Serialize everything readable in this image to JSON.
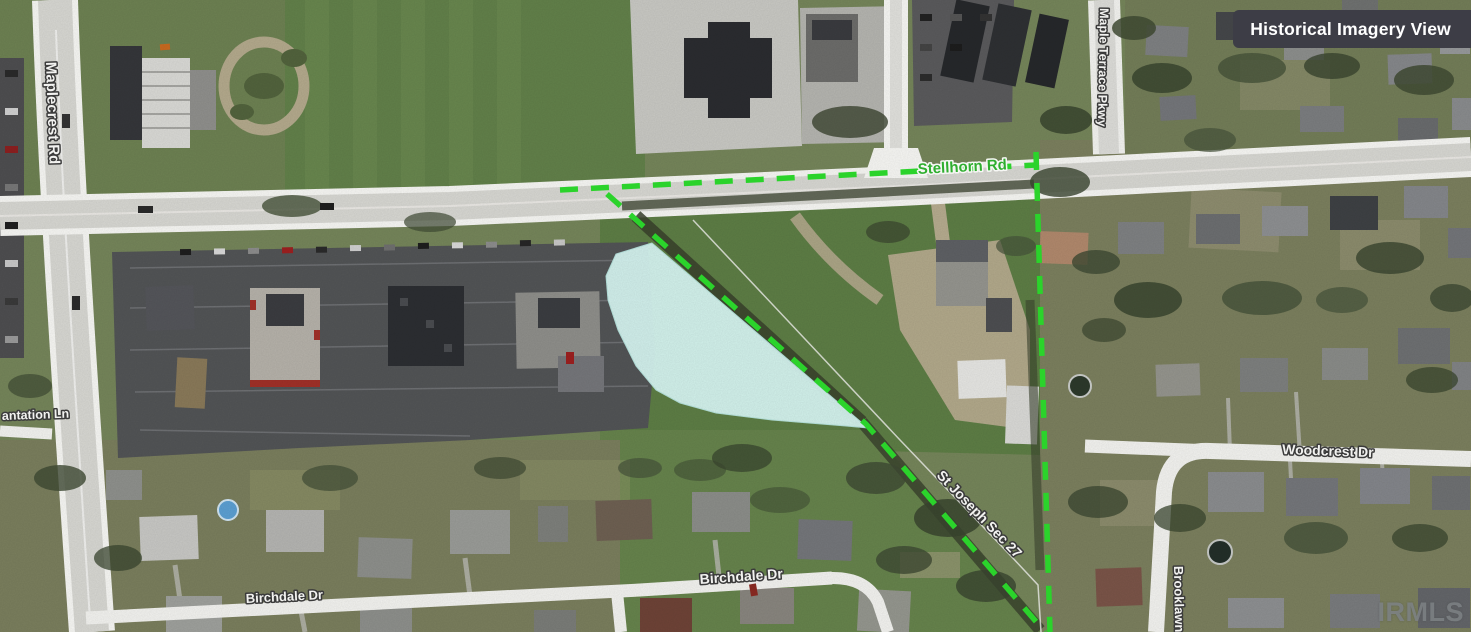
{
  "view": {
    "badge_label": "Historical Imagery View",
    "watermark": "IRMLS"
  },
  "map": {
    "labels": {
      "maplecrest": "Maplecrest Rd",
      "stellhorn": "Stellhorn Rd",
      "maple_terrace": "Maple Terrace Pkwy",
      "plantation": "antation Ln",
      "woodcrest": "Woodcrest Dr",
      "birchdale_west": "Birchdale Dr",
      "birchdale_east": "Birchdale Dr",
      "brooklawn": "Brooklawn",
      "section_line": "St Joseph Sec 27"
    },
    "colors": {
      "boundary_green": "#2bd32b",
      "pond_fill": "#d6f5f1",
      "road_label_green": "#2fae2f",
      "badge_bg": "#3d3d46",
      "badge_text": "#ffffff",
      "watermark_gray": "#808588"
    }
  }
}
